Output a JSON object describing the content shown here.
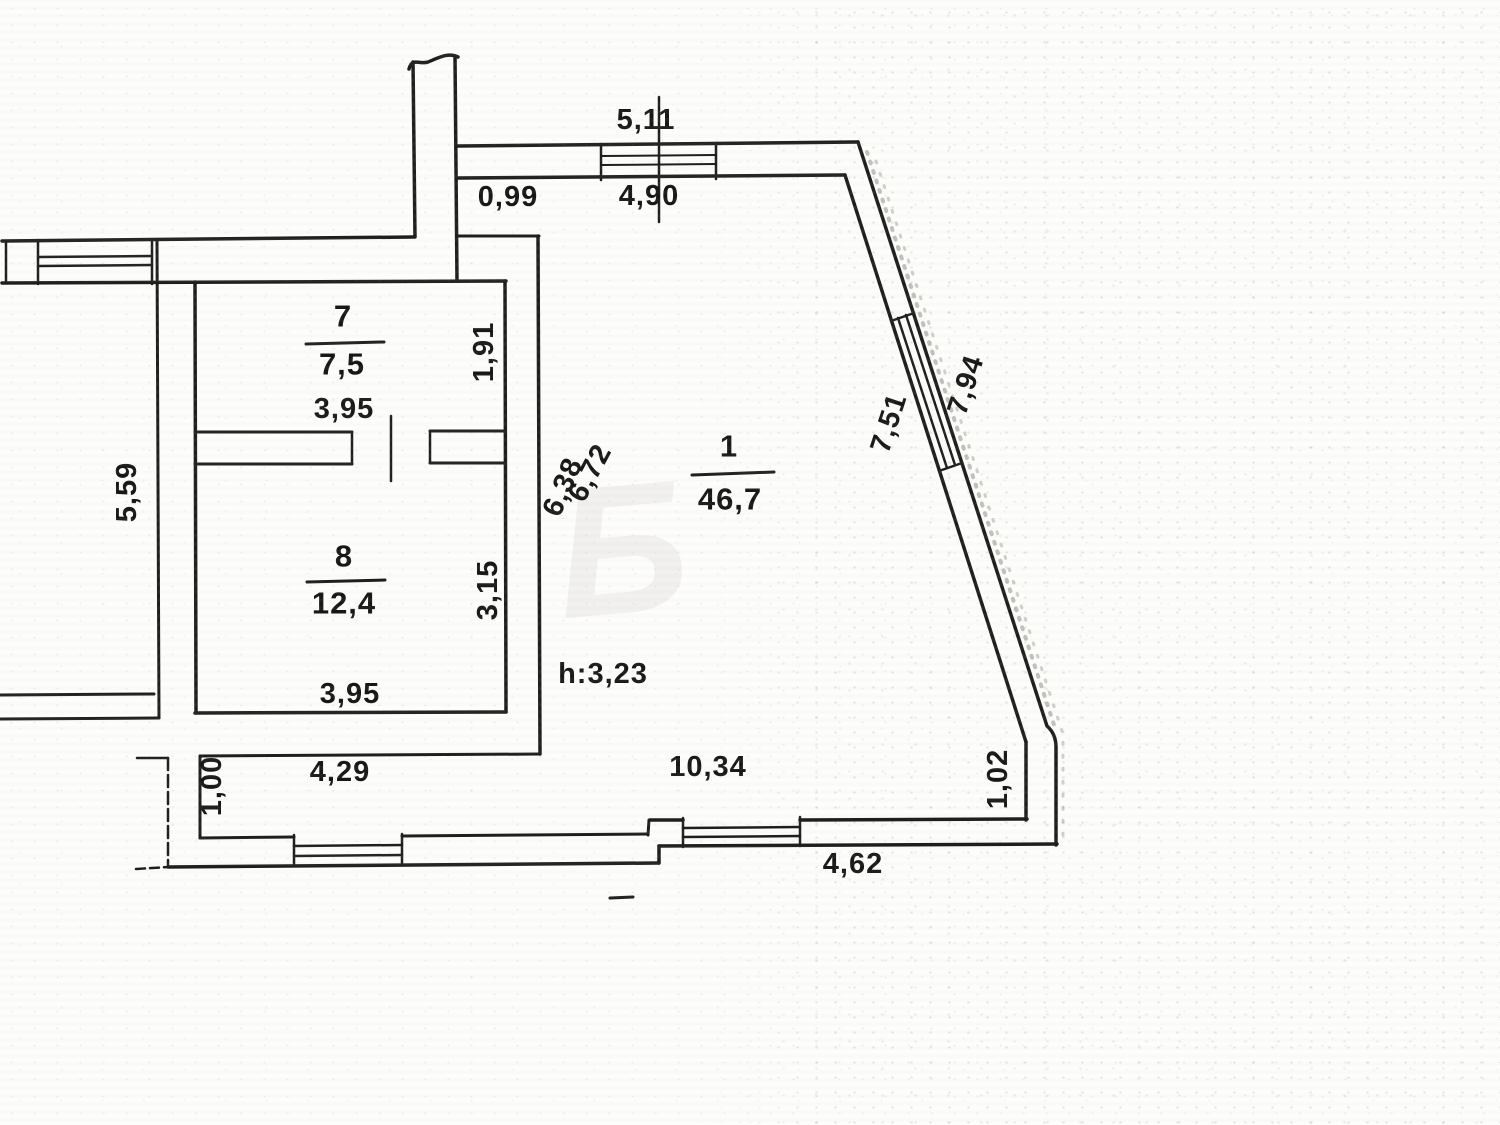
{
  "document": {
    "kind": "scanned floor plan",
    "ink_color": "#1e1e1e",
    "paper_color": "#fdfdfb"
  },
  "rooms": [
    {
      "num": "1",
      "area": "46,7",
      "nx": 729,
      "ny": 446,
      "ax": 730,
      "ay": 499,
      "fx1": 692,
      "fy1": 475,
      "fx2": 774,
      "fy2": 472
    },
    {
      "num": "7",
      "area": "7,5",
      "nx": 343,
      "ny": 316,
      "ax": 342,
      "ay": 364,
      "fx1": 306,
      "fy1": 344,
      "fx2": 384,
      "fy2": 342
    },
    {
      "num": "8",
      "area": "12,4",
      "nx": 344,
      "ny": 556,
      "ax": 344,
      "ay": 603,
      "fx1": 307,
      "fy1": 582,
      "fx2": 385,
      "fy2": 580
    }
  ],
  "height_note": "h:3,23",
  "dimension_labels": [
    {
      "t": "5,11",
      "x": 646,
      "y": 120
    },
    {
      "t": "0,99",
      "x": 508,
      "y": 197
    },
    {
      "t": "4,90",
      "x": 649,
      "y": 196
    },
    {
      "t": "7,51",
      "x": 889,
      "y": 423,
      "r": -72
    },
    {
      "t": "7,94",
      "x": 966,
      "y": 385,
      "r": -72
    },
    {
      "t": "1,91",
      "x": 484,
      "y": 352,
      "r": -90
    },
    {
      "t": "3,95",
      "x": 344,
      "y": 409
    },
    {
      "t": "6,38",
      "x": 563,
      "y": 487,
      "r": -67
    },
    {
      "t": "6,72",
      "x": 590,
      "y": 473,
      "r": -62
    },
    {
      "t": "3,15",
      "x": 488,
      "y": 590,
      "r": -90
    },
    {
      "t": "3,95",
      "x": 350,
      "y": 694
    },
    {
      "t": "5,59",
      "x": 127,
      "y": 492,
      "r": -90
    },
    {
      "t": "h:3,23",
      "x": 603,
      "y": 674
    },
    {
      "t": "10,34",
      "x": 708,
      "y": 767
    },
    {
      "t": "4,29",
      "x": 340,
      "y": 772
    },
    {
      "t": "1,00",
      "x": 212,
      "y": 786,
      "r": -90
    },
    {
      "t": "1,02",
      "x": 998,
      "y": 779,
      "r": -90
    },
    {
      "t": "4,62",
      "x": 853,
      "y": 864
    }
  ],
  "walls": [
    {
      "n": "chimney-left",
      "x1": 413,
      "y1": 62,
      "x2": 415,
      "y2": 237,
      "w": 3.5
    },
    {
      "n": "chimney-right",
      "x1": 455,
      "y1": 56,
      "x2": 457,
      "y2": 281,
      "w": 3.5
    },
    {
      "n": "outer-wall-top-left",
      "x1": 2,
      "y1": 241,
      "x2": 414,
      "y2": 237,
      "w": 3.5
    },
    {
      "n": "inner-wall-top",
      "x1": 2,
      "y1": 283,
      "x2": 506,
      "y2": 281,
      "w": 3.5
    },
    {
      "n": "left-edge-cap",
      "x1": 6,
      "y1": 241,
      "x2": 6,
      "y2": 283,
      "w": 2.5
    },
    {
      "n": "party-wall-left",
      "x1": 157,
      "y1": 241,
      "x2": 159,
      "y2": 718,
      "w": 3
    },
    {
      "n": "neighbor-bottom-inner",
      "x1": 0,
      "y1": 695,
      "x2": 154,
      "y2": 694,
      "w": 3
    },
    {
      "n": "neighbor-bottom-outer",
      "x1": 0,
      "y1": 719,
      "x2": 159,
      "y2": 718,
      "w": 3
    },
    {
      "n": "room-left-wall",
      "x1": 195,
      "y1": 282,
      "x2": 196,
      "y2": 713,
      "w": 3.5
    },
    {
      "n": "room-right-wall",
      "x1": 505,
      "y1": 281,
      "x2": 506,
      "y2": 712,
      "w": 3.5
    },
    {
      "n": "divider-wall-top-a",
      "x1": 195,
      "y1": 432,
      "x2": 352,
      "y2": 432,
      "w": 3
    },
    {
      "n": "divider-wall-top-b",
      "x1": 430,
      "y1": 431,
      "x2": 505,
      "y2": 431,
      "w": 3
    },
    {
      "n": "divider-wall-bot-a",
      "x1": 195,
      "y1": 464,
      "x2": 352,
      "y2": 464,
      "w": 3
    },
    {
      "n": "divider-wall-bot-b",
      "x1": 430,
      "y1": 463,
      "x2": 505,
      "y2": 463,
      "w": 3
    },
    {
      "n": "door-jamb",
      "x1": 352,
      "y1": 432,
      "x2": 352,
      "y2": 464,
      "w": 2.5
    },
    {
      "n": "door-jamb",
      "x1": 430,
      "y1": 431,
      "x2": 430,
      "y2": 463,
      "w": 2.5
    },
    {
      "n": "door-leaf",
      "x1": 391,
      "y1": 416,
      "x2": 391,
      "y2": 481,
      "w": 2.5
    },
    {
      "n": "room8-bottom-wall",
      "x1": 195,
      "y1": 713,
      "x2": 506,
      "y2": 712,
      "w": 3.5
    },
    {
      "n": "wall-step-top",
      "x1": 457,
      "y1": 236,
      "x2": 539,
      "y2": 236,
      "w": 3
    },
    {
      "n": "room1-left-wall",
      "x1": 538,
      "y1": 236,
      "x2": 540,
      "y2": 754,
      "w": 3.5
    },
    {
      "n": "lower-strip-top",
      "x1": 200,
      "y1": 756,
      "x2": 540,
      "y2": 754,
      "w": 3
    },
    {
      "n": "lower-strip-left",
      "x1": 200,
      "y1": 756,
      "x2": 200,
      "y2": 838,
      "w": 3
    },
    {
      "n": "top-wall-outer",
      "x1": 457,
      "y1": 146,
      "x2": 858,
      "y2": 142,
      "w": 3.5
    },
    {
      "n": "top-wall-inner",
      "x1": 457,
      "y1": 178,
      "x2": 845,
      "y2": 175,
      "w": 3.5
    },
    {
      "n": "dim-tick",
      "x1": 659,
      "y1": 97,
      "x2": 659,
      "y2": 222,
      "w": 2.5
    },
    {
      "n": "diagonal-inner",
      "x1": 845,
      "y1": 175,
      "x2": 1026,
      "y2": 742,
      "w": 3.5
    },
    {
      "n": "right-inner-vertical",
      "x1": 1026,
      "y1": 742,
      "x2": 1026,
      "y2": 820,
      "w": 3.5
    },
    {
      "n": "bottom-inner-right",
      "x1": 800,
      "y1": 820,
      "x2": 1027,
      "y2": 819,
      "w": 3.5
    },
    {
      "n": "bottom-inner-mid",
      "x1": 650,
      "y1": 820,
      "x2": 683,
      "y2": 820,
      "w": 3.5
    },
    {
      "n": "bottom-step-inner",
      "x1": 649,
      "y1": 820,
      "x2": 648,
      "y2": 835,
      "w": 3
    },
    {
      "n": "bottom-inner-left-b",
      "x1": 402,
      "y1": 836,
      "x2": 648,
      "y2": 834,
      "w": 3
    },
    {
      "n": "bottom-inner-left-a",
      "x1": 200,
      "y1": 838,
      "x2": 294,
      "y2": 837,
      "w": 3
    },
    {
      "n": "bottom-outer-left",
      "x1": 168,
      "y1": 867,
      "x2": 659,
      "y2": 863,
      "w": 3.5
    },
    {
      "n": "bottom-step-outer",
      "x1": 659,
      "y1": 863,
      "x2": 659,
      "y2": 846,
      "w": 3.5
    },
    {
      "n": "bottom-outer-right",
      "x1": 659,
      "y1": 846,
      "x2": 1057,
      "y2": 844,
      "w": 3.5
    },
    {
      "n": "west-stub-top",
      "x1": 137,
      "y1": 758,
      "x2": 168,
      "y2": 758,
      "w": 2.5
    },
    {
      "n": "west-stub-left",
      "x1": 168,
      "y1": 758,
      "x2": 168,
      "y2": 866,
      "w": 2.5,
      "dash": "12 5"
    },
    {
      "n": "west-stub-bottom",
      "x1": 136,
      "y1": 869,
      "x2": 168,
      "y2": 867,
      "w": 2.5,
      "dash": "9 5"
    },
    {
      "n": "stray-dash",
      "x1": 610,
      "y1": 898,
      "x2": 633,
      "y2": 897,
      "w": 3
    }
  ],
  "window_lines": [
    {
      "n": "window-cap",
      "x1": 38,
      "y1": 240,
      "x2": 38,
      "y2": 284,
      "w": 2.5
    },
    {
      "n": "window-cap",
      "x1": 152,
      "y1": 240,
      "x2": 152,
      "y2": 284,
      "w": 2.5
    },
    {
      "n": "window-glass",
      "x1": 38,
      "y1": 257,
      "x2": 152,
      "y2": 256,
      "w": 2.5
    },
    {
      "n": "window-glass",
      "x1": 38,
      "y1": 266,
      "x2": 152,
      "y2": 265,
      "w": 2.5
    },
    {
      "n": "window-cap",
      "x1": 601,
      "y1": 144,
      "x2": 601,
      "y2": 180,
      "w": 2.5
    },
    {
      "n": "window-cap",
      "x1": 716,
      "y1": 143,
      "x2": 716,
      "y2": 179,
      "w": 2.5
    },
    {
      "n": "window-glass",
      "x1": 601,
      "y1": 156,
      "x2": 716,
      "y2": 155,
      "w": 2
    },
    {
      "n": "window-glass",
      "x1": 601,
      "y1": 165,
      "x2": 716,
      "y2": 164,
      "w": 2
    },
    {
      "n": "window-cap",
      "x1": 891,
      "y1": 321,
      "x2": 914,
      "y2": 313,
      "w": 2.5
    },
    {
      "n": "window-cap",
      "x1": 939,
      "y1": 471,
      "x2": 962,
      "y2": 463,
      "w": 2.5
    },
    {
      "n": "window-glass",
      "x1": 898,
      "y1": 318,
      "x2": 947,
      "y2": 468,
      "w": 2.5
    },
    {
      "n": "window-glass",
      "x1": 906,
      "y1": 315,
      "x2": 955,
      "y2": 465,
      "w": 2.5
    },
    {
      "n": "window-cap",
      "x1": 294,
      "y1": 835,
      "x2": 294,
      "y2": 866,
      "w": 2.5
    },
    {
      "n": "window-cap",
      "x1": 402,
      "y1": 834,
      "x2": 402,
      "y2": 865,
      "w": 2.5
    },
    {
      "n": "window-glass",
      "x1": 294,
      "y1": 846,
      "x2": 402,
      "y2": 845,
      "w": 2.5
    },
    {
      "n": "window-glass",
      "x1": 294,
      "y1": 856,
      "x2": 402,
      "y2": 855,
      "w": 2.5
    },
    {
      "n": "window-cap",
      "x1": 683,
      "y1": 818,
      "x2": 683,
      "y2": 847,
      "w": 2.5
    },
    {
      "n": "window-cap",
      "x1": 800,
      "y1": 817,
      "x2": 800,
      "y2": 846,
      "w": 2.5
    },
    {
      "n": "window-glass",
      "x1": 683,
      "y1": 828,
      "x2": 800,
      "y2": 827,
      "w": 2.5
    },
    {
      "n": "window-glass",
      "x1": 683,
      "y1": 837,
      "x2": 800,
      "y2": 836,
      "w": 2.5
    }
  ],
  "paths": [
    {
      "n": "chimney-break-line",
      "d": "M 409,69 C 412,57 420,65 428,62 C 438,58 448,52 458,57",
      "w": 3.5
    },
    {
      "n": "diagonal-outer-wall",
      "d": "M 858,142 L 1047,726 Q 1056,734 1056,747 L 1056,845",
      "w": 3.5
    }
  ],
  "speckle_paths": [
    {
      "n": "scan-speckle",
      "d": "M 867,152 L 1056,731",
      "w": 4,
      "dash": "2 8",
      "o": 0.4
    },
    {
      "n": "scan-speckle",
      "d": "M 876,161 L 1063,734 L 1063,846",
      "w": 3,
      "dash": "2 11",
      "o": 0.3
    }
  ],
  "watermark": {
    "glyph": "Б",
    "x": 622,
    "y": 550,
    "rot": -5,
    "opacity": 0.08
  }
}
